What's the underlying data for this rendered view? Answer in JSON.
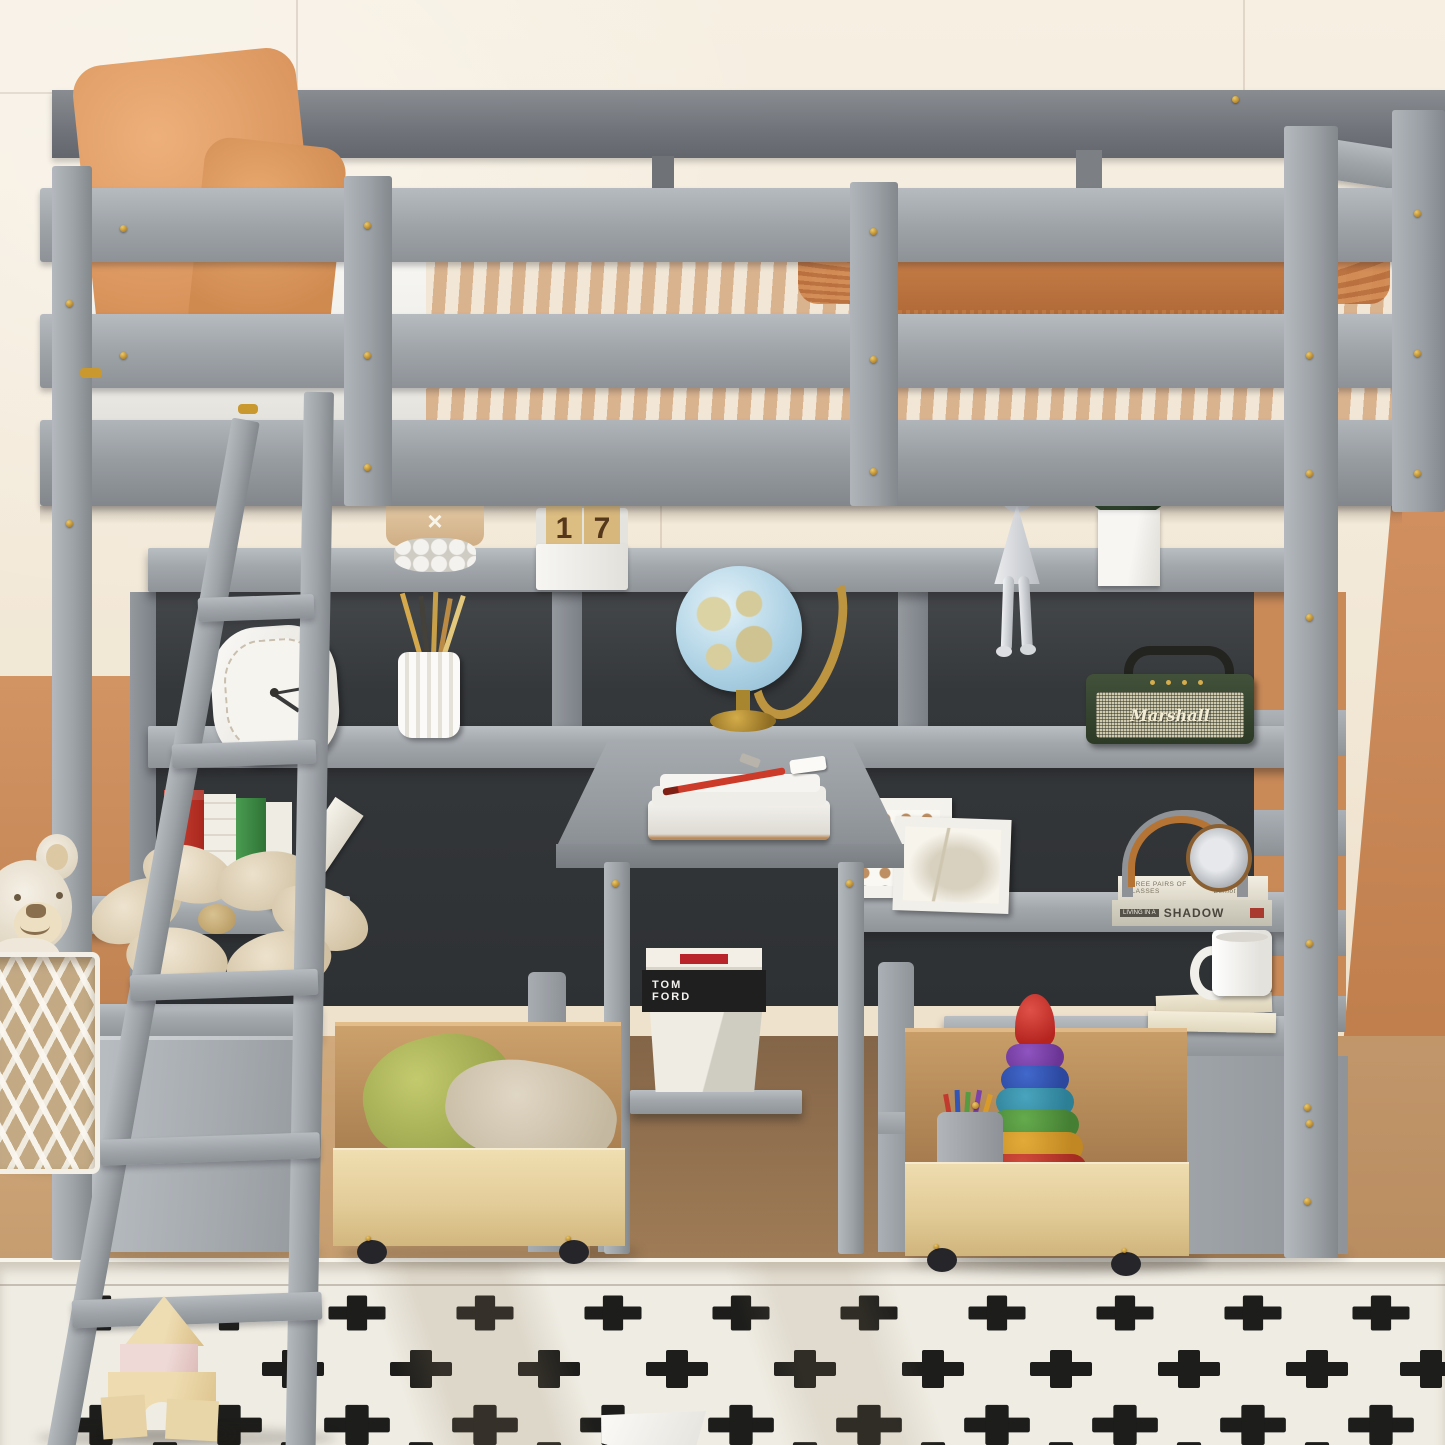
{
  "meta": {
    "subject": "Gray twin-size loft bed with built-in desk, hutch shelves, angled ladder and rolling storage drawers in a kids room"
  },
  "calendar": {
    "weekday": "Wednesday",
    "month": "November",
    "digit_left": "1",
    "digit_right": "7"
  },
  "speaker": {
    "brand": "Marshall"
  },
  "decor": {
    "bead_band_glyph": "×"
  },
  "books": {
    "black_book_line1": "TOM",
    "black_book_line2": "FORD",
    "glasses_title": "THREE PAIRS OF GLASSES",
    "glasses_author": "by Greg Bernot",
    "shadow_prefix": "LIVING IN A",
    "shadow_title": "SHADOW"
  },
  "palette": {
    "frame_gray": "#9ba0a5",
    "frame_gray_dark": "#878c91",
    "back_rail_gray": "#75797e",
    "hutch_panel_dark": "#3c3f42",
    "wall_cream": "#f3e9d8",
    "wall_terracotta": "#c98a58",
    "floor_wood": "#c9a176",
    "rug_white": "#efece3",
    "rug_cross_black": "#1d1d1b",
    "pillow_orange": "#e2a369",
    "blanket_stripe_tan": "#d9b28e",
    "throw_rust": "#c07a45",
    "drawer_wood": "#e6d2a6",
    "marshall_green": "#37462f",
    "marshall_grille": "#cfc9b2",
    "globe_blue": "#a9cfe2",
    "hardware_gold": "#c9992f",
    "pillow_green": "#b9bf63",
    "toy_red": "#c4302e"
  }
}
